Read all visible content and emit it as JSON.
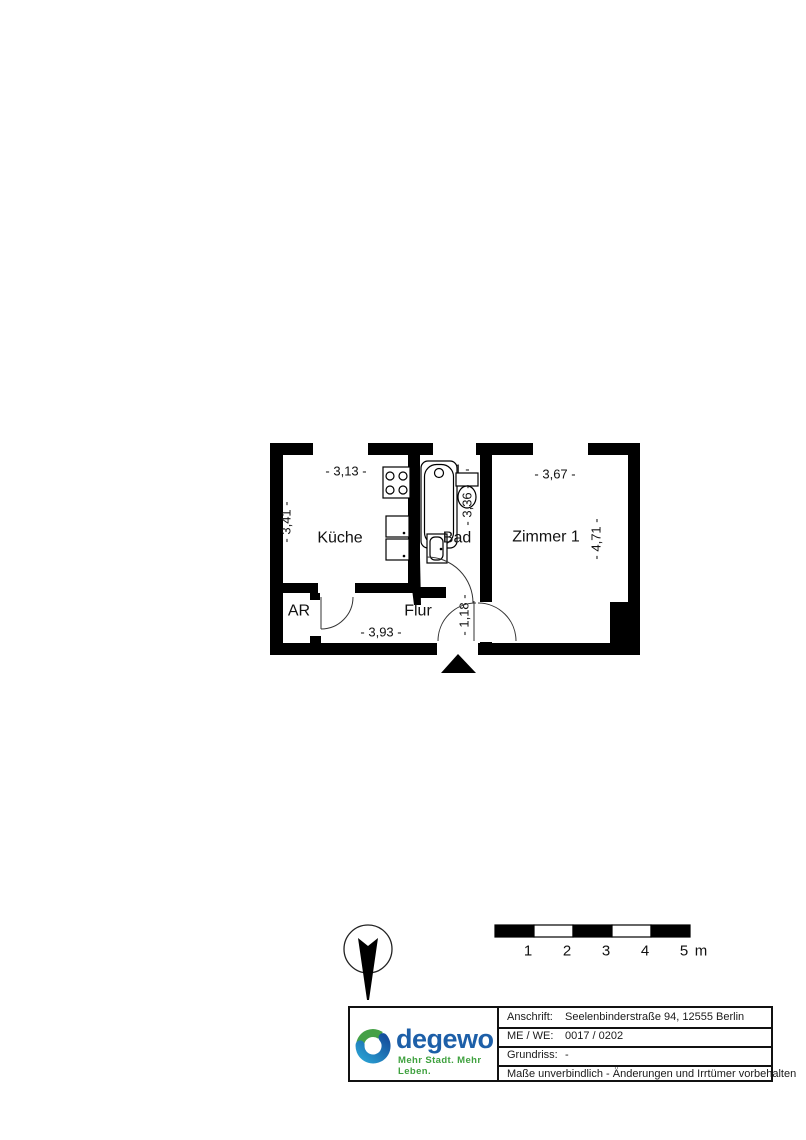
{
  "plan": {
    "rooms": {
      "kueche": "Küche",
      "bad": "Bad",
      "zimmer1": "Zimmer 1",
      "flur": "Flur",
      "ar": "AR"
    },
    "dims": {
      "kueche_w": "- 3,13 -",
      "kueche_h": "- 3,41 -",
      "bad_w": "- 1,51 -",
      "bad_h": "- 3,36 -",
      "zimmer1_w": "- 3,67 -",
      "zimmer1_h": "- 4,71 -",
      "flur_w": "- 3,93 -",
      "entry_h": "- 1,18 -"
    },
    "icons": {
      "north_arrow": "compass-needle-in-circle",
      "entrance": "solid-triangle-up",
      "stove": "four-burner-cooktop",
      "sink": "double-basin-sink",
      "bathtub": "bathtub",
      "toilet": "toilet",
      "washbasin": "washbasin"
    }
  },
  "scalebar": {
    "ticks": [
      "1",
      "2",
      "3",
      "4",
      "5"
    ],
    "unit": "m"
  },
  "titleblock": {
    "brand": {
      "name": "degewo",
      "tagline": "Mehr Stadt. Mehr Leben.",
      "blue": "#1d5fa8",
      "green": "#3fa13f"
    },
    "rows": [
      {
        "label": "Anschrift:",
        "value": "Seelenbinderstraße 94, 12555 Berlin"
      },
      {
        "label": "ME / WE:",
        "value": "0017 / 0202"
      },
      {
        "label": "Grundriss:",
        "value": "-"
      }
    ],
    "disclaimer": "Maße unverbindlich - Änderungen und Irrtümer vorbehalten"
  }
}
